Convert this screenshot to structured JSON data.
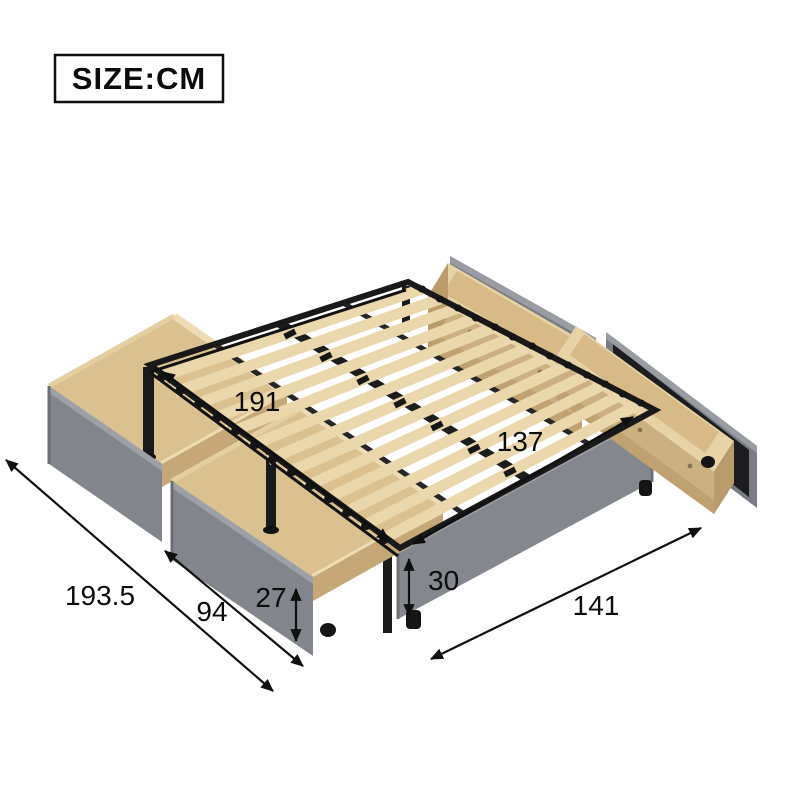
{
  "unit_box": {
    "label": "SIZE:CM"
  },
  "dims": {
    "bed_length": "191",
    "bed_width": "137",
    "overall_depth_with_drawers": "193.5",
    "drawer_front_width": "94",
    "drawer_front_height": "27",
    "side_rail_height": "30",
    "overall_width_side": "141"
  },
  "colors": {
    "wood_light": "#e7d3a6",
    "wood_floor": "#d9bd8c",
    "wood_wall": "#cdb081",
    "wood_wall_dark": "#b99b6c",
    "fabric_gray": "#82858b",
    "fabric_gray_light": "#9da0a6",
    "panel_black": "#1d1d1f",
    "metal_black": "#1a1a1a",
    "dimension_line": "#0f0f0f"
  }
}
